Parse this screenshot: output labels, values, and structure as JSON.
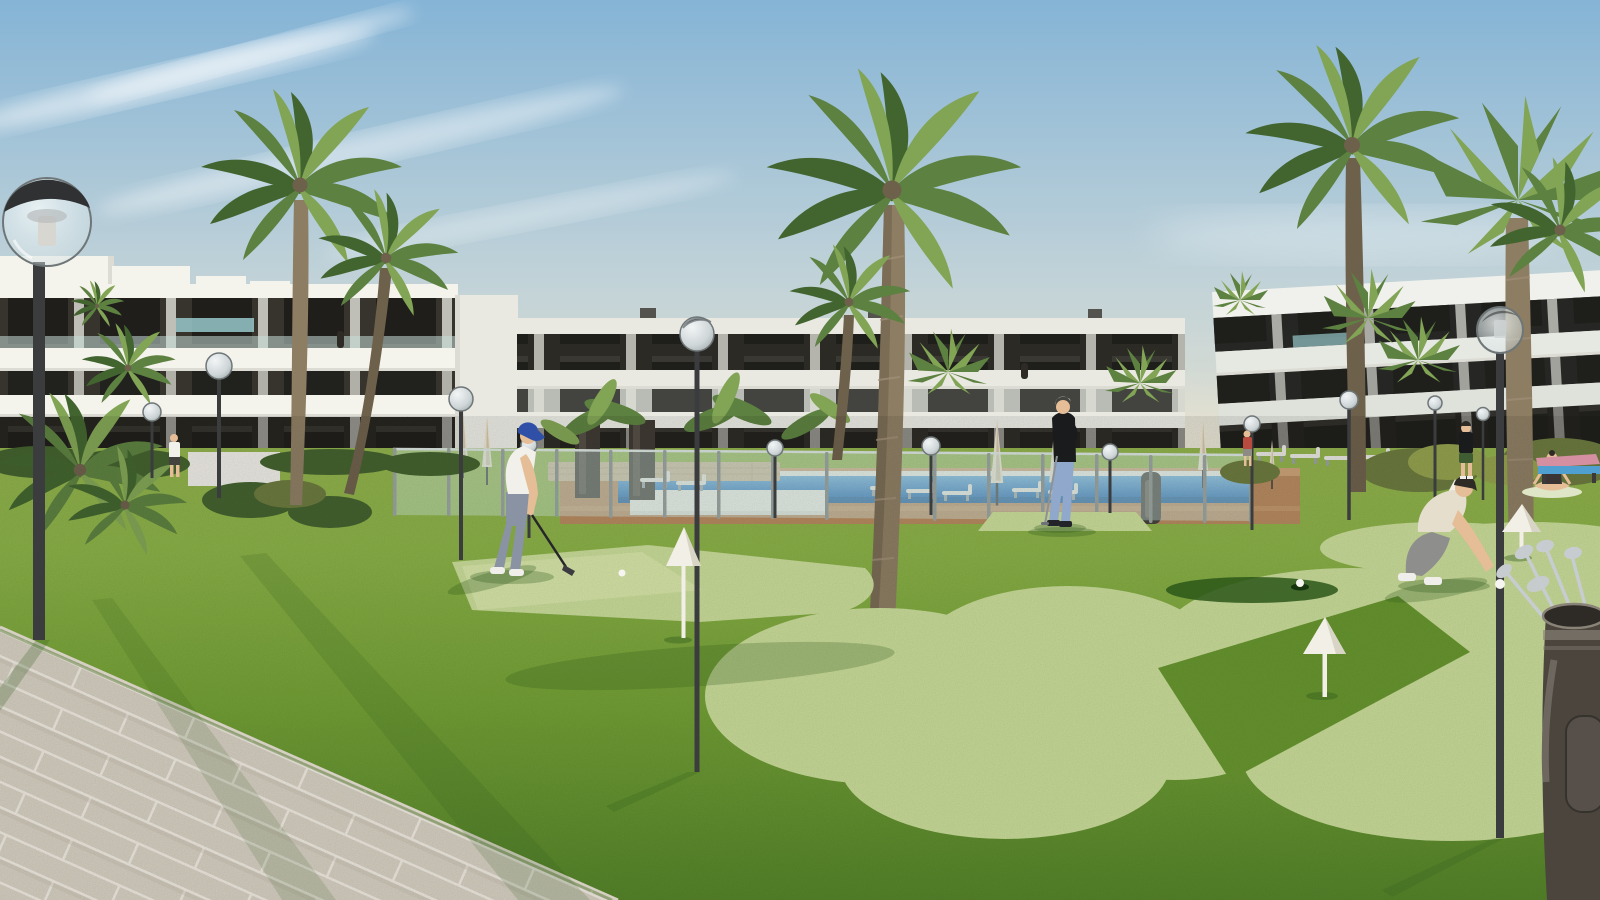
{
  "meta": {
    "type": "architectural-render",
    "subject": "Modern white apartment complex with communal putting green, swimming pool and palm trees at golden hour",
    "canvas_width": 1600,
    "canvas_height": 900
  },
  "palette": {
    "skyTop": "#85b4d6",
    "skyMid": "#c0d2d8",
    "skyHaze": "#eae3cf",
    "cloud": "#ffffff",
    "bldWhiteL": "#f4f3ec",
    "bldWhiteC": "#e9e9e2",
    "bldWhiteR": "#f0f1ec",
    "slabShade": "#dcdcd4",
    "darkBandL": "#37342d",
    "darkBandC": "#2b2a25",
    "darkBandR": "#262624",
    "windowGlass": "#1c1c19",
    "windowGlint": "#5a5850",
    "glassAqua": "#9fd2d6",
    "railGlass": "#c6dcd9",
    "grass": "#74a136",
    "grassLight": "#8bb148",
    "grassFar": "#90b14c",
    "grassDark": "#55842a",
    "grassShadow": "#2f5a1c",
    "green": "#c9dc99",
    "greenBright": "#d6e5a8",
    "holeDark": "#2c5719",
    "holeCup": "#16350d",
    "walk": "#d6d0c2",
    "walkJoint": "#efeae0",
    "walkShade": "#c2bbaa",
    "pool": "#2e74b8",
    "poolLight": "#6aa8d8",
    "poolDeep": "#24619e",
    "coping": "#e9e9e3",
    "deck": "#b5895f",
    "deckLight": "#c9a176",
    "fenceGlass": "rgba(210,235,228,0.40)",
    "fencePost": "#9aa39f",
    "poleDark": "#3a3c3e",
    "lampCap": "#2f3133",
    "sphereRim": "#6e7678",
    "stoneWall": "#c9b697",
    "whiteWall": "#eceae3",
    "binGrey": "#45423c",
    "umbrella": "#e9e0cc",
    "umbrellaShade": "#cfc3a9",
    "lounger": "#e5e4de",
    "loungerLeg": "#9aa0a0",
    "palmTrunk": "#8d7d63",
    "palmTrunkShade": "#6e614c",
    "palmGreen": "#5d8140",
    "palmGreenDark": "#42652f",
    "palmGreenLight": "#82a455",
    "bushOlive": "#6c7a3f",
    "bushDark": "#44622f",
    "bushGold": "#93a14e",
    "skin": "#e5bd96",
    "hairDark": "#2e2a26",
    "hairGrey": "#b8b4ac",
    "capBlue": "#3050a8",
    "shirtWhite": "#f2f0ea",
    "golferPants": "#8a93a3",
    "jeansBlue": "#8fa8cc",
    "sweaterBlack": "#1a1b1d",
    "teeBeige": "#e5decd",
    "crouchPants": "#8e8e8c",
    "shoeWhite": "#efeeea",
    "shoeDark": "#23242a",
    "shortsGreen": "#3f5c33",
    "topRed": "#b84a40",
    "yogaTop": "#3a3435",
    "matLight": "#dfe6c8",
    "bagBody": "#4b453e",
    "bagTrim": "#8a8378",
    "bagPocket": "#57504a",
    "clubSteel": "#c7ccd1",
    "ball": "#f6f5f0",
    "tablePink": "#d490a0",
    "tableBlue": "#4f9fd0",
    "coneWhite": "#f2efe7",
    "coneShade": "#d8d4c6"
  },
  "scene": {
    "buildings": [
      {
        "id": "left-building",
        "label": "three-storey white apartment block, sunlit, roof terraces"
      },
      {
        "id": "center-building",
        "label": "three-storey white apartment block behind pool"
      },
      {
        "id": "right-building",
        "label": "three-storey apartment block in shade, near right edge"
      }
    ],
    "people": [
      {
        "id": "golfer",
        "label": "man in white polo and blue cap putting on practice green"
      },
      {
        "id": "standing-man",
        "label": "grey-haired man in black sweater and light jeans leaning on putter"
      },
      {
        "id": "crouching-man",
        "label": "man in beige tee crouching to place golf ball by cone marker"
      },
      {
        "id": "yoga-woman",
        "label": "woman sitting cross-legged on mat near table"
      },
      {
        "id": "walking-person",
        "label": "person in dark top and green shorts walking on lawn"
      },
      {
        "id": "small-person-left",
        "label": "distant person in white top on left lawn"
      },
      {
        "id": "person-red-top",
        "label": "distant person in red top near pool right end"
      }
    ],
    "props": [
      "globe street lamps",
      "white cone hole markers",
      "golf balls",
      "golf bag with clubs",
      "swimming pool with glass fence",
      "sun loungers",
      "closed parasols",
      "stone-tiled walkway",
      "litter bin",
      "outdoor table",
      "display totems"
    ],
    "vegetation": [
      "tall date palms",
      "fan palms",
      "banana plants",
      "clipped shrubs"
    ]
  }
}
